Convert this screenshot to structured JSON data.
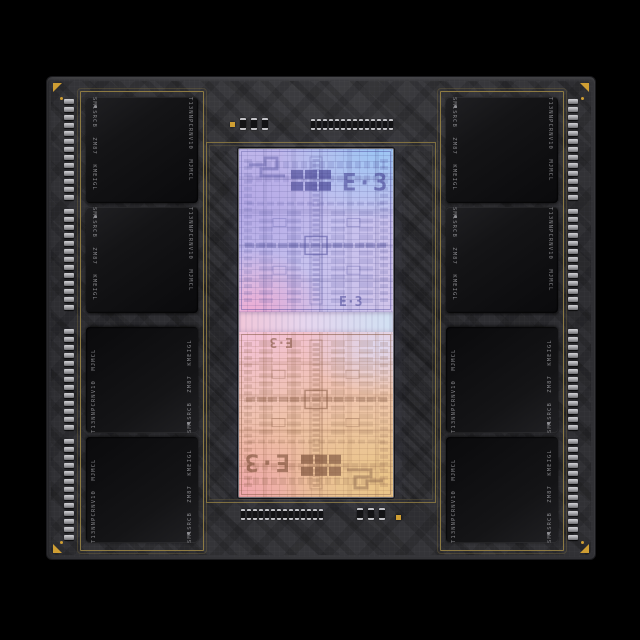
{
  "colors": {
    "bg": "#000000",
    "substrate": "#2e2e32",
    "gold": "#cf9e33",
    "goldline": "#8d7a42",
    "chip-text": "#8e8e92",
    "pad": "#b0b0b4",
    "cir-top": "#4a4898",
    "cir-bottom": "#7b4f38"
  },
  "memory": {
    "chip_count": 8,
    "label_left": "SM1SRCB ZM87 KMEIGL",
    "label_right": "T13NNPCRNV10 MJMCL"
  },
  "die": {
    "glyph_large": "E·3",
    "glyph_small": "E·3"
  },
  "layout": {
    "pads_per_group": 13,
    "caps_row": 14,
    "caps_small": 3,
    "corner_fiducials": 4,
    "gold_dots": 4,
    "gold_squares": 2
  }
}
